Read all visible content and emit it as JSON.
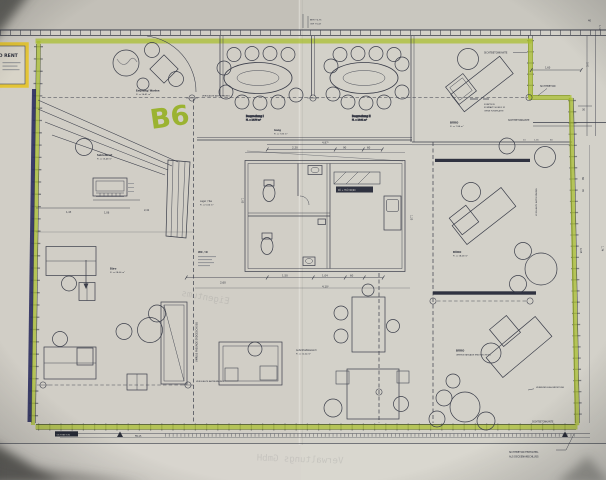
{
  "plan": {
    "unit_mark": "B6",
    "rent_label": "TO RENT",
    "rooms": {
      "empfang": {
        "name": "Empfang/ Warten",
        "area": "Fl. = 16,41 m²"
      },
      "besprechung_1": {
        "name": "Besprechung I",
        "area": "Fl. = 16,76 m²"
      },
      "besprechung_2": {
        "name": "Besprechung II",
        "area": "Fl. = 16,81 m²"
      },
      "gang": {
        "name": "Gang",
        "area": "Fl. = 7,95 m²"
      },
      "sekretariat": {
        "name": "Sekretariat",
        "area": "Fl. = 15,48 m²"
      },
      "buero_left": {
        "name": "Büro",
        "area": "Fl. = 28,06 m²"
      },
      "wc_d": {
        "name": "WC / D"
      },
      "lager_tee": {
        "name": "Lager / Tee",
        "area": "Fl. = 5,56 m²"
      },
      "kueche_tag": "KÜ + TKÜ 90/60",
      "buero_right_1": {
        "name": "BÜRO",
        "area": "Fl. = 7,98 m²"
      },
      "buero_right_2": {
        "name": "BÜRO",
        "area": "Fl. = 18,08 m²"
      },
      "buero_right_3": {
        "name": "BÜRO",
        "note": "UMRISS FASSADE ERDGESCHOSS"
      },
      "aufenthalt": {
        "name": "Aufenthaltsbereich",
        "area": "Fl. = 12,04 m²"
      }
    },
    "notes": {
      "sichtbetonkante": "SICHTBETONKANTE",
      "sichtbeton": "SICHTBETON",
      "verglaste_abtrennung": "VERGLASTE ABTRENNUNG",
      "umriss_fassade": "UMRISS FASSADE ERDGESCHOSS",
      "verbundglas": "VERBUNDGLAS BRÜSTUNG",
      "fertigteil_1": "SICHTBETON FERTIGTEIL",
      "fertigteil_2": "ALS DECKENANSCHLUSS",
      "funktion_1": "FUNKTION",
      "funktion_2": "KOMPAKT 90/45/2 M",
      "funktion_3": "OHNE FUSSPLATTE",
      "brh": "BRH +0,75",
      "okf": "OKF +0,67",
      "bottom_tag": "SICHTBETON",
      "sheet_ref": "FB-15"
    },
    "dims": {
      "d220": "2,20",
      "d90": "90",
      "d60": "60",
      "d487": "4,87⁵",
      "d260": "2,60",
      "d150": "1,50",
      "d104": "1,04",
      "d410": "4,10⁵",
      "d143": "1,43",
      "d106": "1,06",
      "d241": "2,41",
      "d105": "1,05",
      "d125": "1,25",
      "d160": "1,60",
      "d30": "30",
      "d10": "10",
      "d116": "1,16",
      "d40": "40",
      "d114": "1,14",
      "d301": "3,01",
      "d86": "86",
      "d35": "35",
      "d405": "4,05",
      "d174": "1,74"
    },
    "bleed_through": {
      "t1": "Eigentums",
      "t2": "Verwaltungs GmbH"
    }
  },
  "colors": {
    "highlighter_green": "#a9bf2c",
    "highlighter_yellow": "#e5c52f",
    "marker_navy": "#2b2e5e",
    "ink": "#3a3d49",
    "paper": "#d1cec6"
  }
}
